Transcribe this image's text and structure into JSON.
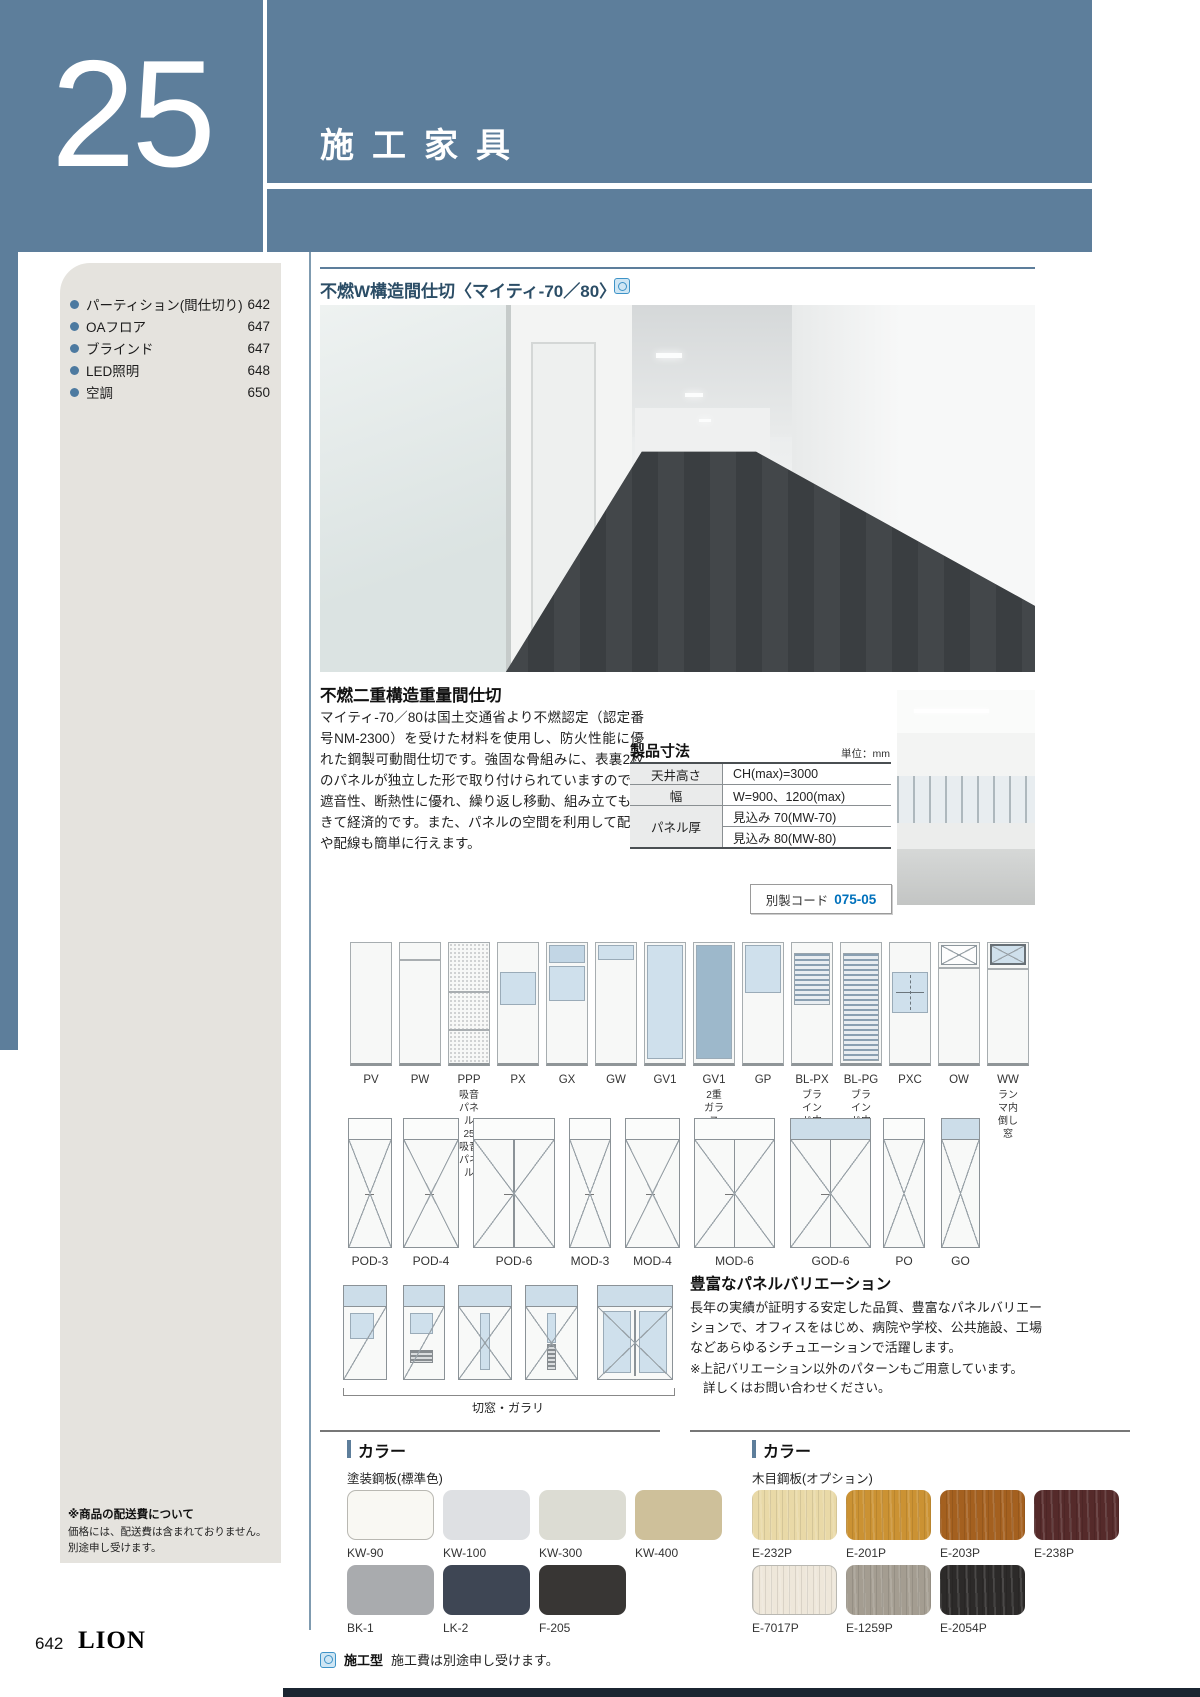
{
  "theme": {
    "accent": "#5d7e9b",
    "code_blue": "#0071bc"
  },
  "header": {
    "chapter_number": "25",
    "chapter_title": "施工家具"
  },
  "sidebar": {
    "items": [
      {
        "label": "パーティション(間仕切り)",
        "page": "642"
      },
      {
        "label": "OAフロア",
        "page": "647"
      },
      {
        "label": "ブラインド",
        "page": "647"
      },
      {
        "label": "LED照明",
        "page": "648"
      },
      {
        "label": "空調",
        "page": "650"
      }
    ],
    "note_title": "※商品の配送費について",
    "note_line1": "価格には、配送費は含まれておりません。",
    "note_line2": "別途申し受けます。"
  },
  "product": {
    "title": "不燃W構造間仕切〈マイティ-70／80〉",
    "section_heading": "不燃二重構造重量間仕切",
    "description": "マイティ-70／80は国土交通省より不燃認定（認定番号NM-2300）を受けた材料を使用し、防火性能に優れた鋼製可動間仕切です。強固な骨組みに、表裏2枚のパネルが独立した形で取り付けられていますので、遮音性、断熱性に優れ、繰り返し移動、組み立てもできて経済的です。また、パネルの空間を利用して配管や配線も簡単に行えます。"
  },
  "spec": {
    "title": "製品寸法",
    "unit": "単位：mm",
    "rows": [
      {
        "h": "天井高さ",
        "v": "CH(max)=3000"
      },
      {
        "h": "幅",
        "v": "W=900、1200(max)"
      },
      {
        "h": "パネル厚",
        "v": "見込み 70(MW-70)",
        "v2": "見込み 80(MW-80)"
      }
    ],
    "code_label": "別製コード",
    "code_value": "075-05"
  },
  "panels": {
    "items": [
      {
        "label": "PV",
        "sub": "",
        "type": "plain"
      },
      {
        "label": "PW",
        "sub": "",
        "type": "divided"
      },
      {
        "label": "PPP",
        "sub": "吸音パネル\n25吸音パネル",
        "type": "acoustic"
      },
      {
        "label": "PX",
        "sub": "",
        "type": "window-mid"
      },
      {
        "label": "GX",
        "sub": "",
        "type": "glass-top2"
      },
      {
        "label": "GW",
        "sub": "",
        "type": "glass-strip"
      },
      {
        "label": "GV1",
        "sub": "",
        "type": "glass-full"
      },
      {
        "label": "GV1",
        "sub": "2重ガラス",
        "type": "glass-full-dark"
      },
      {
        "label": "GP",
        "sub": "",
        "type": "glass-upper"
      },
      {
        "label": "BL-PX",
        "sub": "ブラインド内蔵",
        "type": "blind-mid"
      },
      {
        "label": "BL-PG",
        "sub": "ブラインド内蔵",
        "type": "blind-full"
      },
      {
        "label": "PXC",
        "sub": "",
        "type": "window-slide"
      },
      {
        "label": "OW",
        "sub": "",
        "type": "open-top"
      },
      {
        "label": "WW",
        "sub": "ランマ内倒し窓",
        "type": "tilt-top"
      }
    ]
  },
  "doors": {
    "row1": [
      {
        "label": "POD-3",
        "x": 348,
        "w": 44,
        "transom": "white",
        "style": "single"
      },
      {
        "label": "POD-4",
        "x": 403,
        "w": 56,
        "transom": "white",
        "style": "single"
      },
      {
        "label": "POD-6",
        "x": 473,
        "w": 82,
        "transom": "white",
        "style": "double"
      },
      {
        "label": "MOD-3",
        "x": 569,
        "w": 42,
        "transom": "white",
        "style": "single"
      },
      {
        "label": "MOD-4",
        "x": 625,
        "w": 55,
        "transom": "white",
        "style": "single"
      },
      {
        "label": "MOD-6",
        "x": 694,
        "w": 81,
        "transom": "white",
        "style": "double"
      },
      {
        "label": "GOD-6",
        "x": 790,
        "w": 81,
        "transom": "blue",
        "style": "double"
      },
      {
        "label": "PO",
        "x": 883,
        "w": 42,
        "transom": "white",
        "style": "xonly"
      },
      {
        "label": "GO",
        "x": 941,
        "w": 39,
        "transom": "blue",
        "style": "xonly"
      }
    ],
    "row2": [
      {
        "x": 343,
        "w": 44,
        "kind": "sq-window"
      },
      {
        "x": 403,
        "w": 42,
        "kind": "window-louver"
      },
      {
        "x": 458,
        "w": 54,
        "kind": "slit"
      },
      {
        "x": 525,
        "w": 53,
        "kind": "slit-louver"
      },
      {
        "x": 597,
        "w": 76,
        "kind": "double-glass"
      }
    ],
    "row2_caption": "切窓・ガラリ"
  },
  "variation": {
    "heading": "豊富なパネルバリエーション",
    "body": "長年の実績が証明する安定した品質、豊富なパネルバリエーションで、オフィスをはじめ、病院や学校、公共施設、工場などあらゆるシチュエーションで活躍します。",
    "note1": "※上記バリエーション以外のパターンもご用意しています。",
    "note2": "詳しくはお問い合わせください。"
  },
  "colors": {
    "left": {
      "heading": "カラー",
      "subheading": "塗装鋼板(標準色)",
      "swatches": [
        {
          "label": "KW-90",
          "hex": "#f9f8f3"
        },
        {
          "label": "KW-100",
          "hex": "#dee0e3"
        },
        {
          "label": "KW-300",
          "hex": "#dcdcd3"
        },
        {
          "label": "KW-400",
          "hex": "#cec09a"
        },
        {
          "label": "BK-1",
          "hex": "#a9abae"
        },
        {
          "label": "LK-2",
          "hex": "#3e4654"
        },
        {
          "label": "F-205",
          "hex": "#383634"
        }
      ]
    },
    "right": {
      "heading": "カラー",
      "subheading": "木目鋼板(オプション)",
      "swatches": [
        {
          "label": "E-232P",
          "hex": "#e9d9a7"
        },
        {
          "label": "E-201P",
          "hex": "#cb9233"
        },
        {
          "label": "E-203P",
          "hex": "#a4601f"
        },
        {
          "label": "E-238P",
          "hex": "#552a2a"
        },
        {
          "label": "E-7017P",
          "hex": "#eee7da"
        },
        {
          "label": "E-1259P",
          "hex": "#a49d91"
        },
        {
          "label": "E-2054P",
          "hex": "#2c2a29"
        }
      ]
    }
  },
  "footer": {
    "page_number": "642",
    "brand": "LION",
    "note_label": "施工型",
    "note_text": "施工費は別途申し受けます。"
  }
}
